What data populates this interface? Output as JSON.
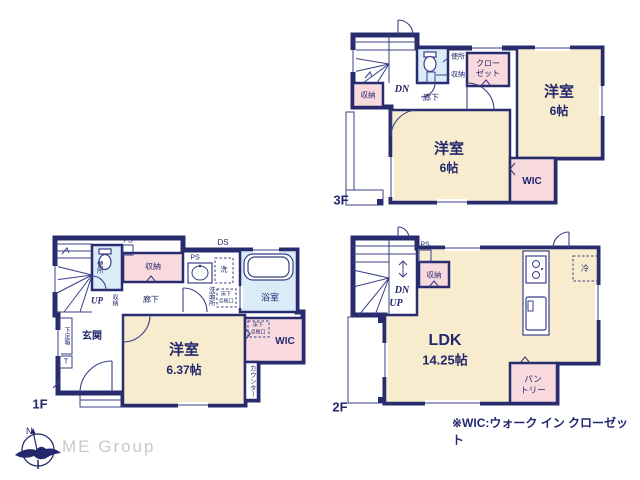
{
  "palette": {
    "wall": "#282c6e",
    "cream": "#f8ecce",
    "pink": "#f8dade",
    "blue": "#d9ecf8",
    "text": "#23276b",
    "logo_gray": "#c9c9c9"
  },
  "footnote": "※WIC:ウォーク イン クローゼット",
  "logo": {
    "name": "ME Group",
    "compass_north": "N"
  },
  "floor3": {
    "label": "3F",
    "bedroom_right_name": "洋室",
    "bedroom_right_size": "6帖",
    "bedroom_center_name": "洋室",
    "bedroom_center_size": "6帖",
    "closet_line1": "クロー",
    "closet_line2": "ゼット",
    "wic": "WIC",
    "toilet": "便所",
    "storage_a": "収納",
    "storage_b": "収納",
    "hall": "廊下",
    "stair_dn": "DN"
  },
  "floor2": {
    "label": "2F",
    "ldk_name": "LDK",
    "ldk_size": "14.25帖",
    "storage": "収納",
    "pantry_line1": "パン",
    "pantry_line2": "トリー",
    "fridge": "冷",
    "ps": "PS",
    "stair_dn": "DN",
    "stair_up": "UP"
  },
  "floor1": {
    "label": "1F",
    "bedroom_name": "洋室",
    "bedroom_size": "6.37帖",
    "entrance": "玄関",
    "shoe_box": "下足箱",
    "shoe_box_t": "T",
    "toilet": "便所",
    "ps_a": "PS",
    "ps_b": "PS",
    "ds": "DS",
    "storage_top": "収納",
    "storage_hall": "収納",
    "hall": "廊下",
    "stair_up": "UP",
    "washroom": "洗面所",
    "laundry": "洗",
    "bath": "浴室",
    "hatch_wash_line1": "床下",
    "hatch_wash_line2": "点検口",
    "hatch_wic_line1": "床下",
    "hatch_wic_line2": "点検口",
    "wic": "WIC",
    "counter": "カウンター"
  }
}
